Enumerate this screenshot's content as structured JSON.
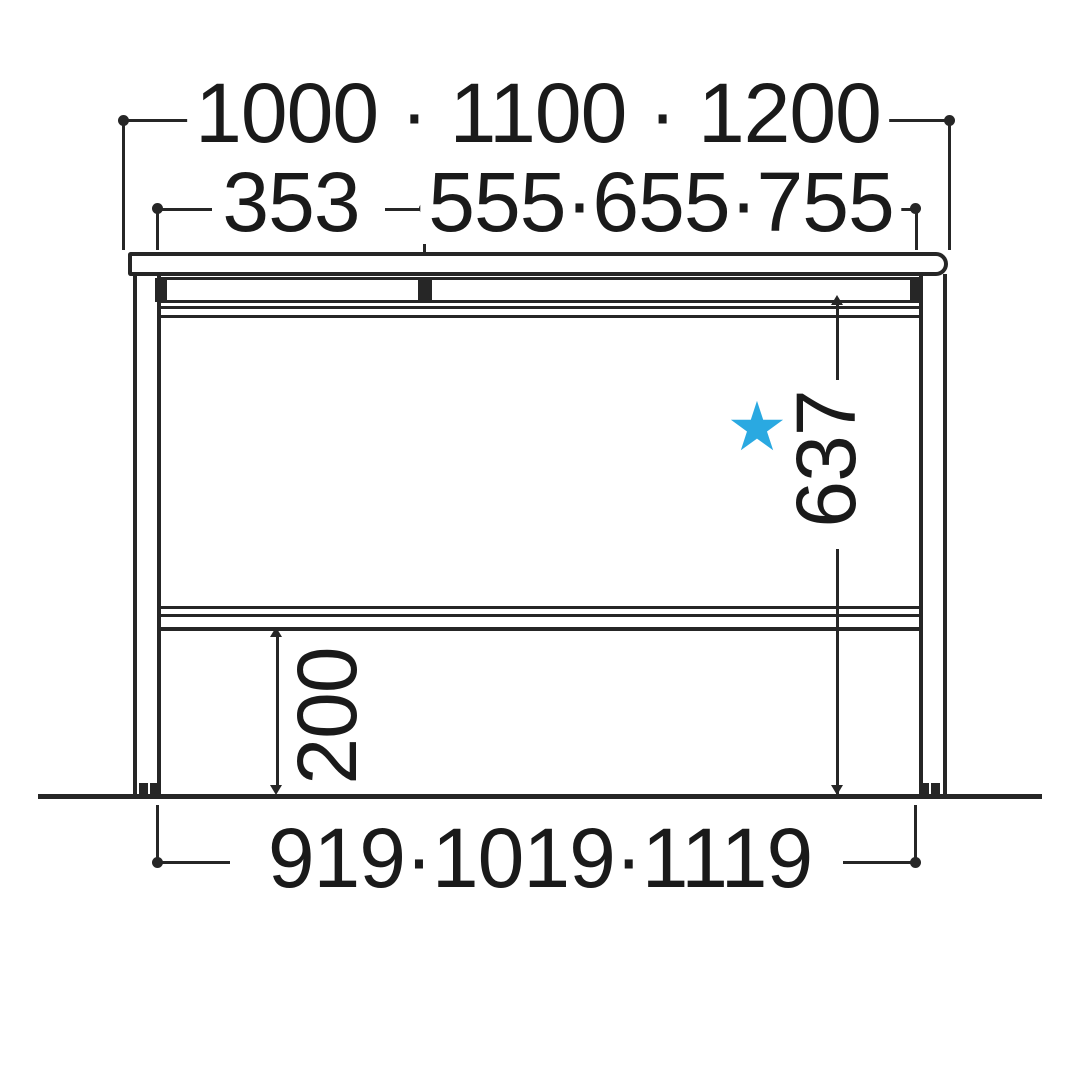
{
  "diagram": {
    "name": "desk-front-elevation-dimension-diagram",
    "line_color": "#262626",
    "text_color": "#1a1a1a",
    "labels": {
      "overall_width": "1000 · 1100 · 1200",
      "left_section_width": "353",
      "right_section_width": "555·655·755",
      "inner_height": "637",
      "bottom_clearance": "200",
      "leg_span_width": "919·1019·1119"
    },
    "star": {
      "glyph": "★",
      "color": "#2AA9E1"
    }
  }
}
